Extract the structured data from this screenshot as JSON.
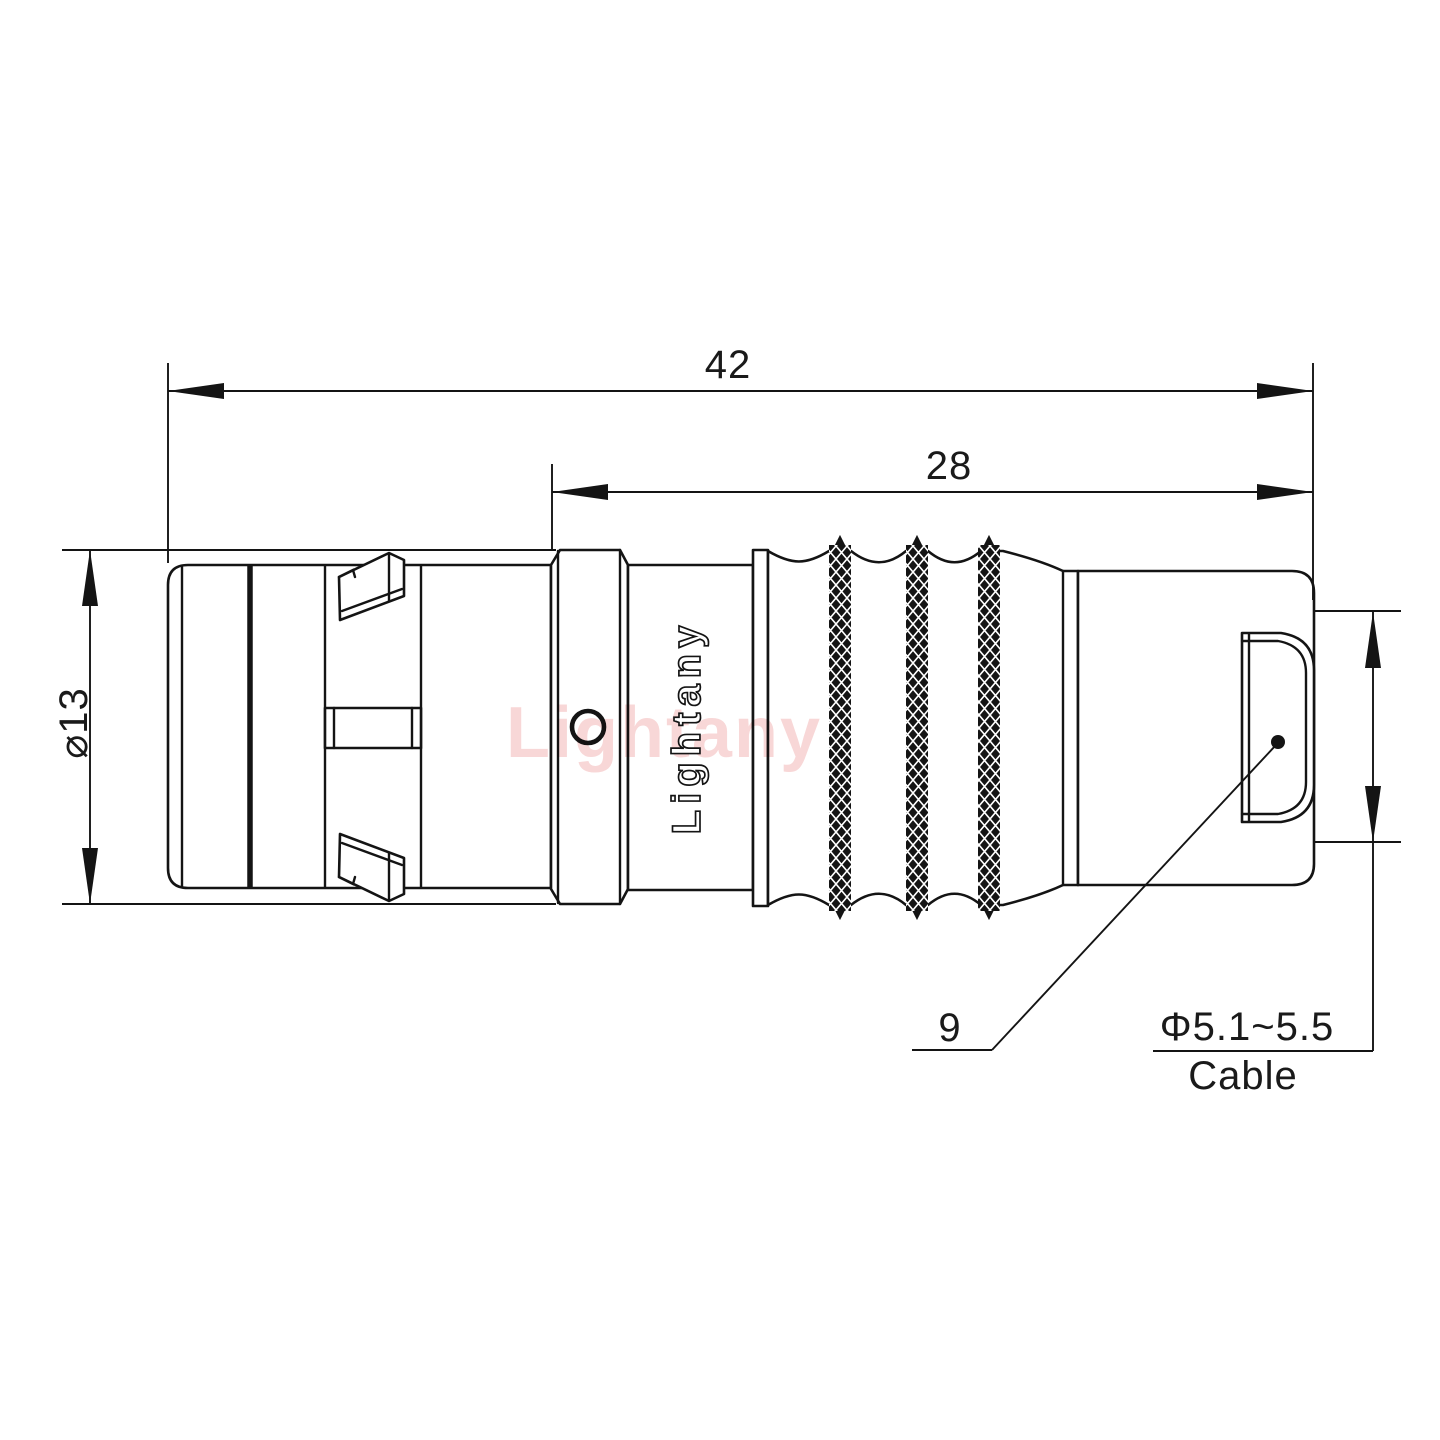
{
  "drawing": {
    "type": "connector technical drawing",
    "watermark": "Lightany",
    "body_logo": "Lightany",
    "dimensions": {
      "overall_length": "42",
      "rear_length": "28",
      "shell_diameter": "⌀13",
      "nut_reference": "9",
      "cable_diameter": "Φ5.1~5.5",
      "cable_label": "Cable"
    },
    "colors": {
      "line": "#141414",
      "watermark": "#f2b6b6",
      "background": "#ffffff"
    }
  }
}
